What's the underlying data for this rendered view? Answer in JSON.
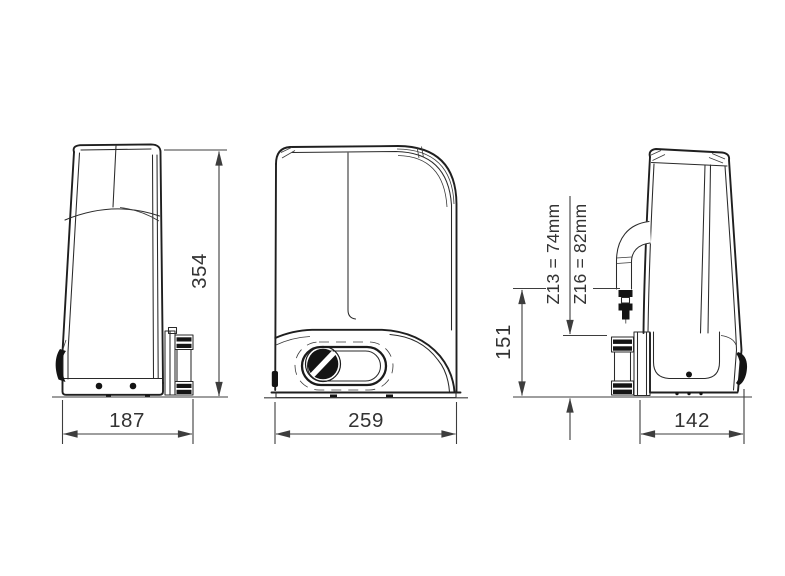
{
  "diagram": {
    "views": {
      "side_left": {
        "height_label": "354",
        "width_label": "187"
      },
      "front": {
        "width_label": "259"
      },
      "side_right": {
        "height_label": "151",
        "width_label": "142",
        "pinion_z13_label": "Z13 = 74mm",
        "pinion_z16_label": "Z16 = 82mm"
      }
    },
    "colors": {
      "background": "#ffffff",
      "outline": "#1f1f1f",
      "dimension_lines": "#3d3d3d",
      "label_text": "#333333"
    }
  }
}
